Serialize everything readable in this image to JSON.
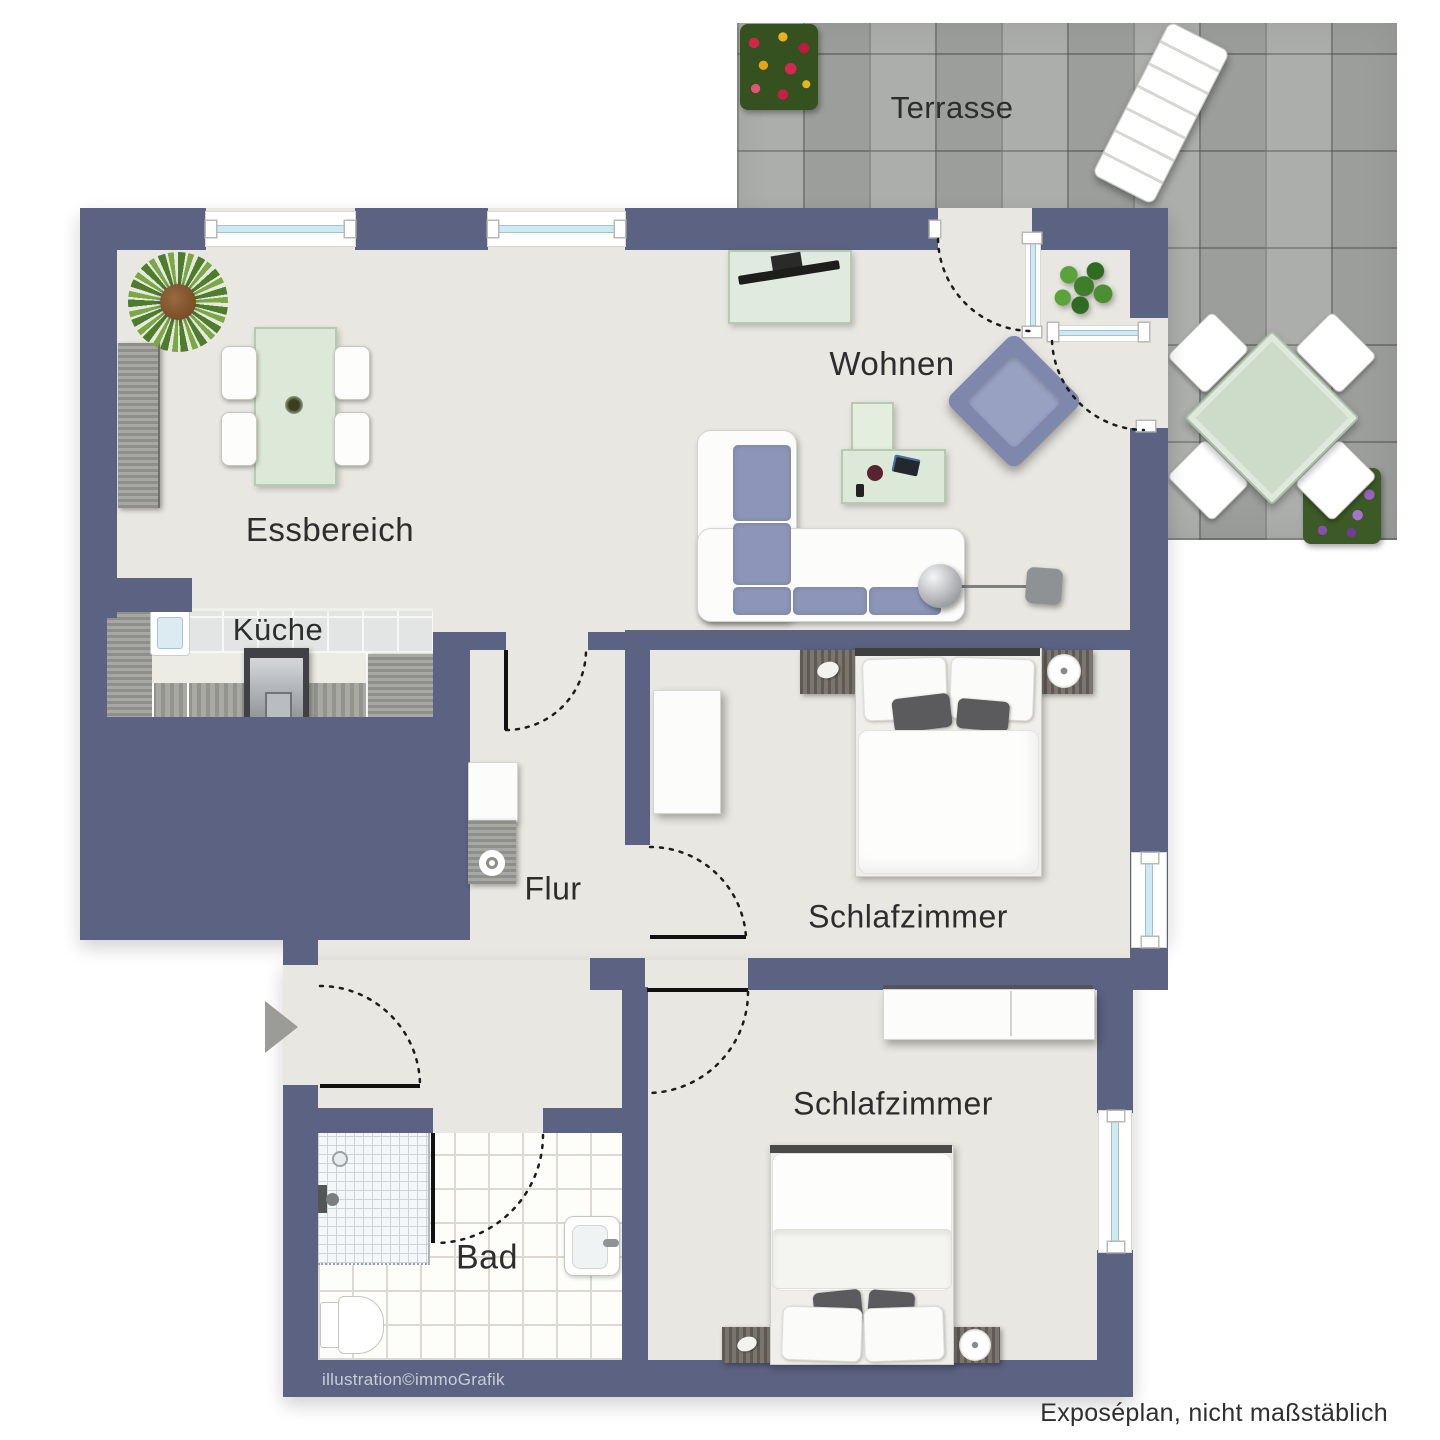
{
  "rooms": {
    "terrasse": {
      "label": "Terrasse"
    },
    "wohnen": {
      "label": "Wohnen"
    },
    "essbereich": {
      "label": "Essbereich"
    },
    "kueche": {
      "label": "Küche"
    },
    "flur": {
      "label": "Flur"
    },
    "schlafzimmer1": {
      "label": "Schlafzimmer"
    },
    "schlafzimmer2": {
      "label": "Schlafzimmer"
    },
    "bad": {
      "label": "Bad"
    }
  },
  "footer": {
    "credit": "illustration©immoGrafik",
    "note": "Exposéplan, nicht maßstäblich"
  },
  "colors": {
    "wall": "#5b6282",
    "floor": "#e9e7e1",
    "terrace_tile": "#a6a8a6",
    "window_glass": "#cfe9f2",
    "seat_blue": "#8d96b8",
    "glass_table_green": "#dce9d8",
    "entrance_arrow": "#9b9b98"
  },
  "icons": [
    "potted-palm-icon",
    "bush-plant-icon",
    "flower-box-icon",
    "sun-lounger-icon",
    "terrace-table-icon",
    "terrace-chair-icon",
    "dining-table-icon",
    "dining-chair-icon",
    "sideboard-icon",
    "tv-sideboard-icon",
    "corner-sofa-icon",
    "coffee-table-icon",
    "armchair-icon",
    "floor-lamp-icon",
    "kitchen-unit-icon",
    "stove-icon",
    "kitchen-sink-icon",
    "washing-machine-icon",
    "double-bed-icon",
    "nightstand-icon",
    "wardrobe-icon",
    "shower-icon",
    "toilet-icon",
    "washbasin-icon",
    "door-swing-icon",
    "entrance-arrow-icon"
  ]
}
